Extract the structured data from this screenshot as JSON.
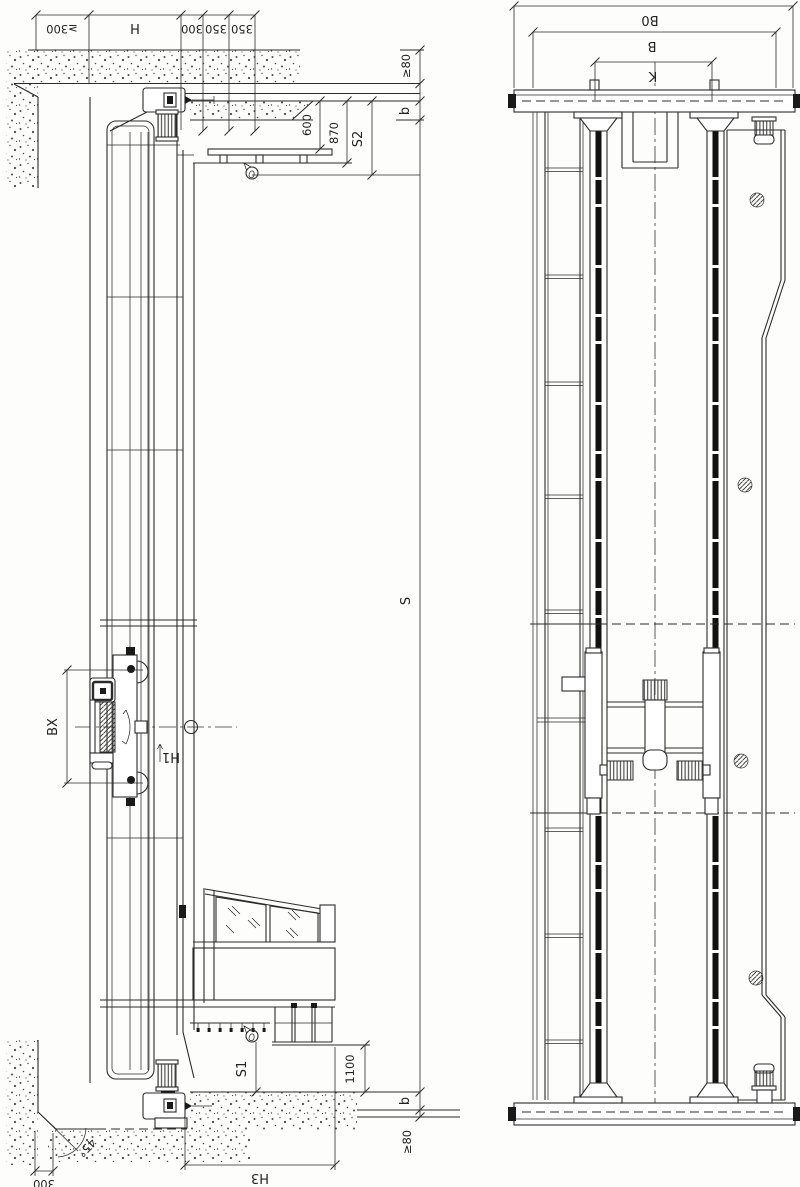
{
  "left_view": {
    "top_dimensions": {
      "wall_clearance": "≥300",
      "height_h": "H",
      "spacing_300": "300",
      "spacing_350_a": "350",
      "spacing_350_b": "350",
      "top_clearance": "≥80",
      "rail_height_b": "b",
      "offset_600": "600",
      "offset_870": "870",
      "clearance_s2": "S2"
    },
    "mast_dimensions": {
      "travel_s": "S",
      "carriage_bx": "BX",
      "height_h1": "H1"
    },
    "bottom_dimensions": {
      "fork_s1": "S1",
      "offset_1100": "1100",
      "height_h3": "H3",
      "rail_height_b": "b",
      "bottom_clearance": "≥80",
      "slope_angle": "45°",
      "edge_300": "300"
    }
  },
  "right_view": {
    "dimensions": {
      "overall_width_b0": "B0",
      "width_b": "B",
      "wheel_gauge_k": "K"
    }
  }
}
